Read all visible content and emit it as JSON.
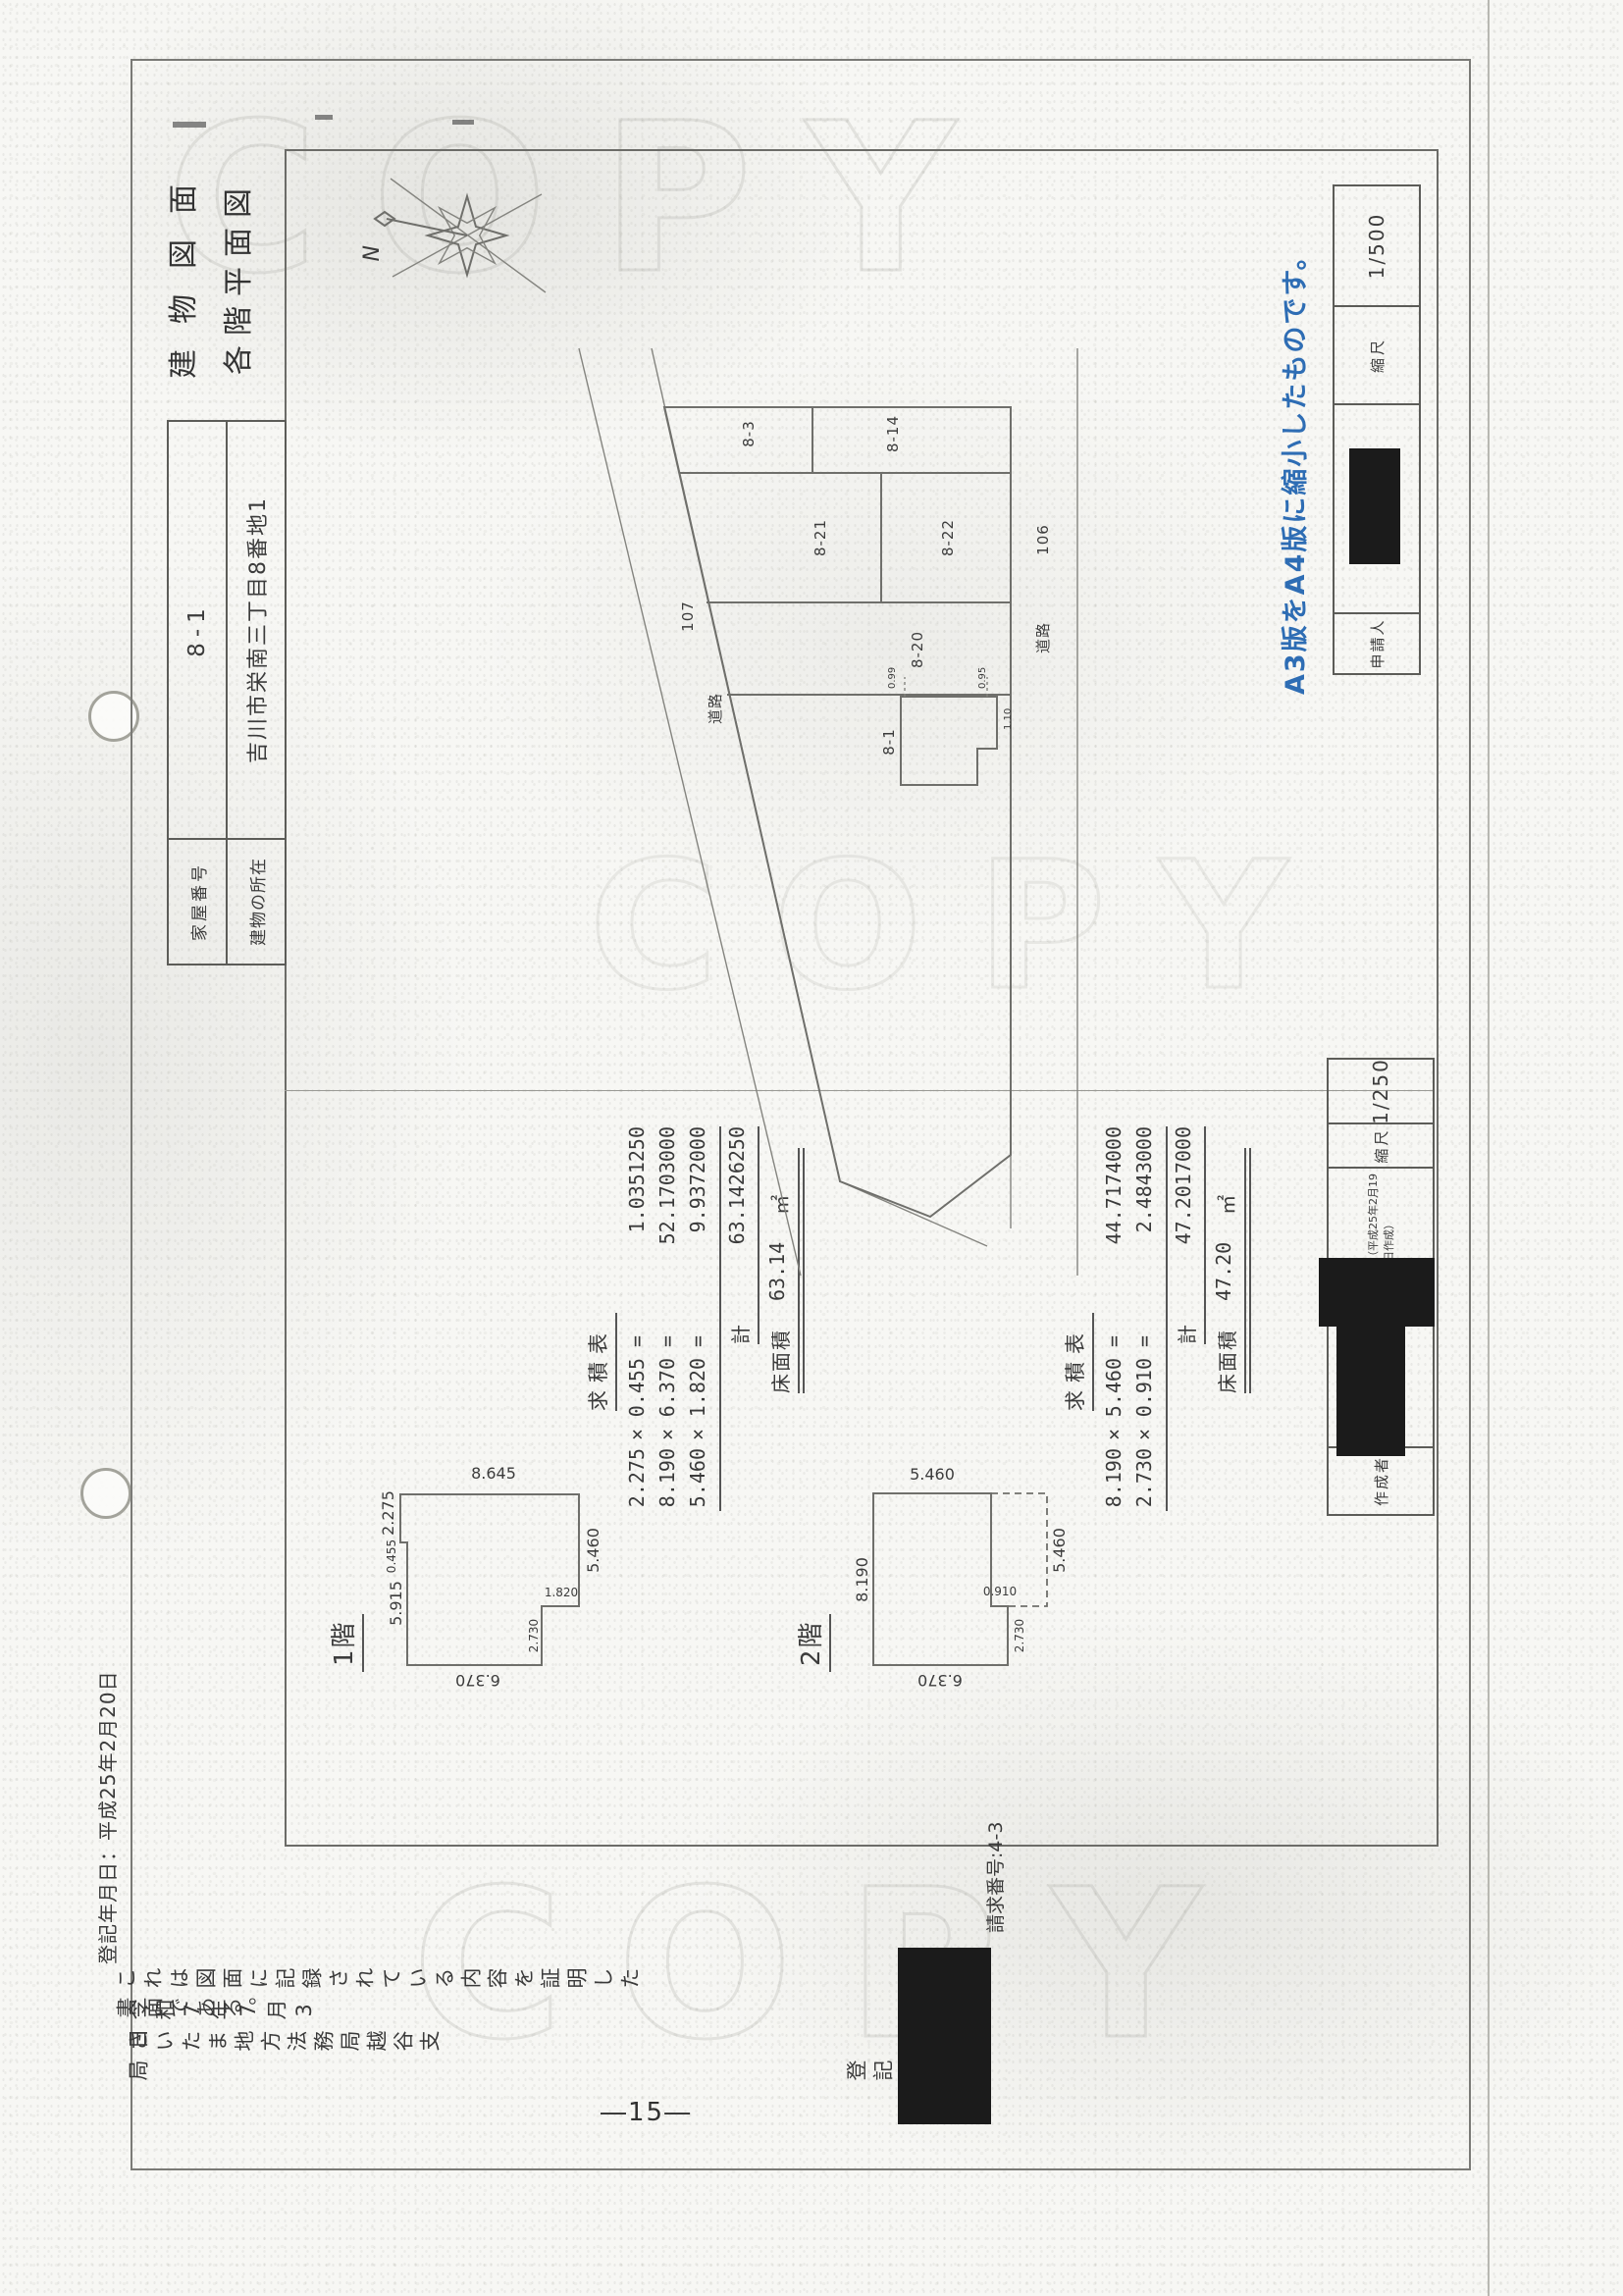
{
  "meta": {
    "page_number": "―15―",
    "request_number": "請求番号:4-3",
    "registration_date": "登記年月日：平成25年2月20日",
    "watermark": "COPY",
    "a3_note": "A3版をA4版に縮小したものです。",
    "note_color": "#2e6db4"
  },
  "certification": {
    "statement": "これは図面に記録されている内容を証明した書面である。",
    "date": "令和7年7月3日",
    "office": "さいたま地方法務局越谷支局",
    "officer_label": "登記官"
  },
  "header": {
    "title_line1": "建物図面",
    "title_line2": "各階平面図",
    "house_number_label": "家屋番号",
    "house_number": "8-1",
    "location_label": "建物の所在",
    "location": "吉川市栄南三丁目8番地1"
  },
  "blocks": {
    "creator_label": "作成者",
    "creation_note": "（平成25年2月19日作成）",
    "floor_scale_label": "縮尺",
    "floor_scale": "1/250",
    "applicant_label": "申請人",
    "site_scale_label": "縮尺",
    "site_scale": "1/500"
  },
  "site_plan": {
    "north_label": "N",
    "parcels": {
      "p83": "8-3",
      "p814": "8-14",
      "p821": "8-21",
      "p822": "8-22",
      "p820": "8-20",
      "p81": "8-1"
    },
    "road_numbers": {
      "r107": "107",
      "r106": "106"
    },
    "road_label_1": "道路",
    "road_label_2": "道路",
    "offsets": {
      "o1": "0.99",
      "o2": "0.95",
      "o3": "1.10"
    }
  },
  "floor1": {
    "label": "1階",
    "dims": {
      "top_left": "5.915",
      "step": "0.455",
      "top_right": "2.275",
      "right": "8.645",
      "bottom": "5.460",
      "left": "6.370",
      "notch_v": "1.820",
      "notch_h": "2.730"
    },
    "table": {
      "title": "求積表",
      "rows": [
        {
          "f1": "2.275",
          "op": "×",
          "f2": "0.455",
          "eq": "=",
          "result": "1.0351250"
        },
        {
          "f1": "8.190",
          "op": "×",
          "f2": "6.370",
          "eq": "=",
          "result": "52.1703000"
        },
        {
          "f1": "5.460",
          "op": "×",
          "f2": "1.820",
          "eq": "=",
          "result": "9.9372000"
        }
      ],
      "total_label": "計",
      "total": "63.1426250",
      "area_label": "床面積",
      "area": "63.14",
      "unit": "㎡"
    }
  },
  "floor2": {
    "label": "2階",
    "dims": {
      "top": "8.190",
      "right": "5.460",
      "left": "6.370",
      "step_h": "2.730",
      "step_v": "0.910",
      "dashed_bottom": "5.460"
    },
    "table": {
      "title": "求積表",
      "rows": [
        {
          "f1": "8.190",
          "op": "×",
          "f2": "5.460",
          "eq": "=",
          "result": "44.7174000"
        },
        {
          "f1": "2.730",
          "op": "×",
          "f2": "0.910",
          "eq": "=",
          "result": "2.4843000"
        }
      ],
      "total_label": "計",
      "total": "47.2017000",
      "area_label": "床面積",
      "area": "47.20",
      "unit": "㎡"
    }
  }
}
